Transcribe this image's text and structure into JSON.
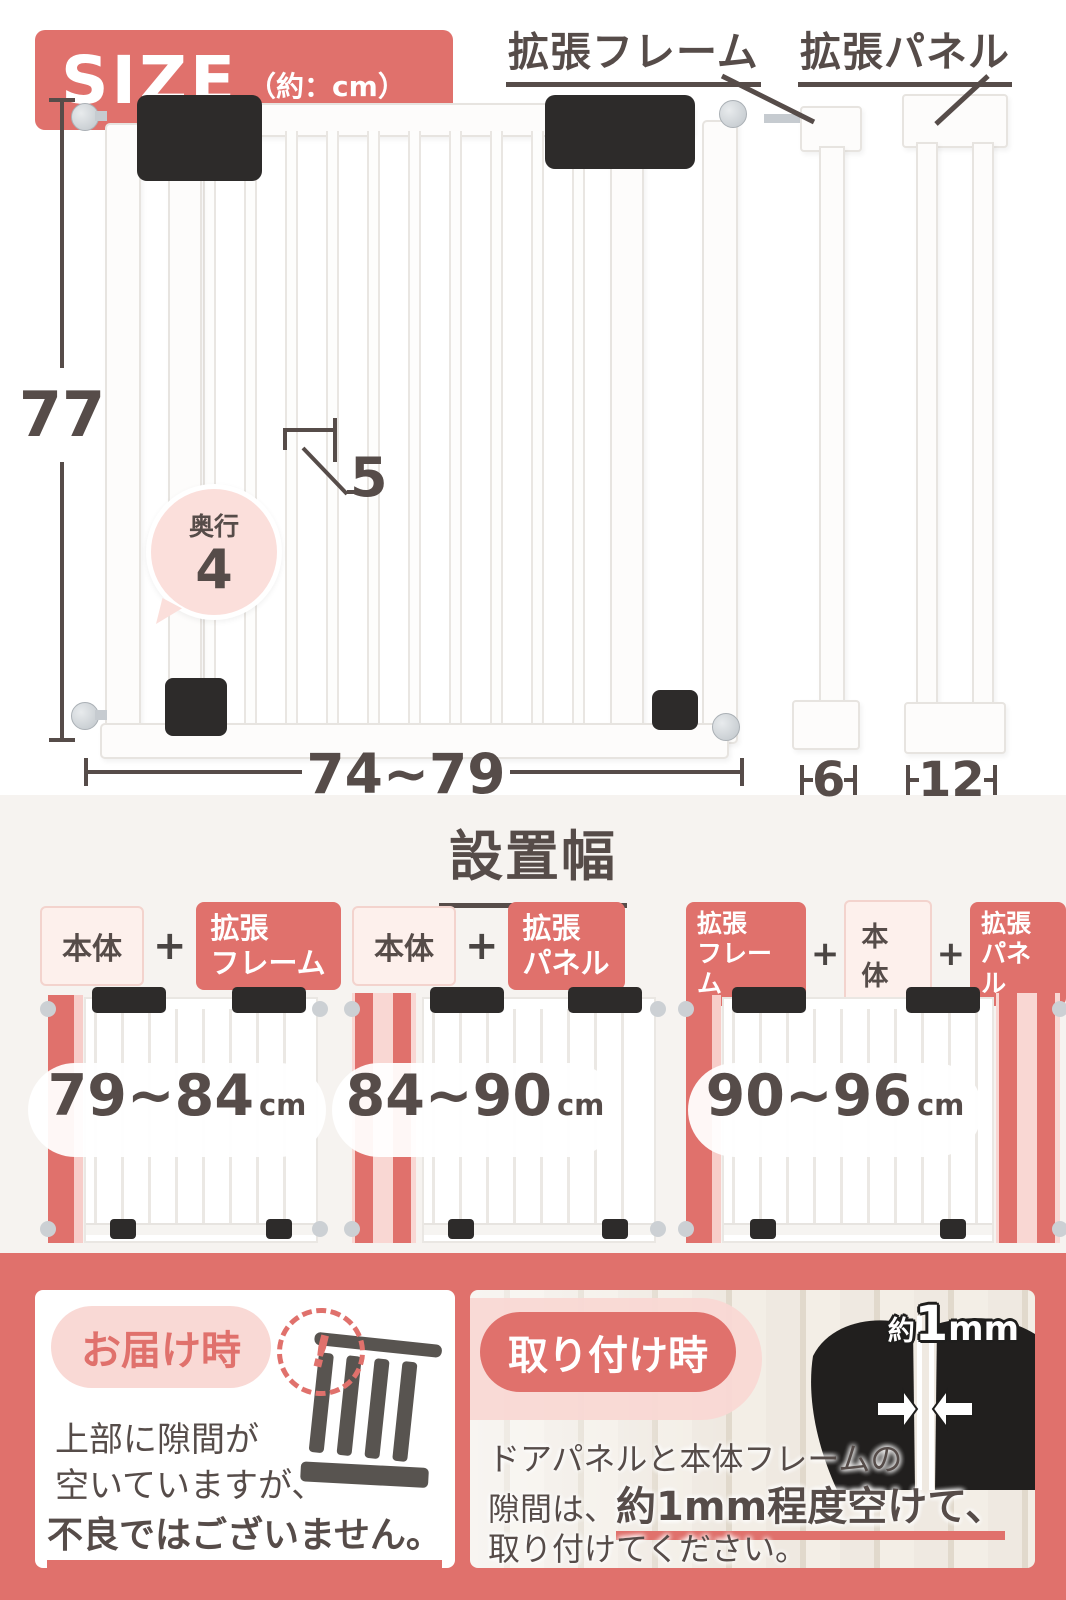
{
  "colors": {
    "accent_salmon": "#E0716C",
    "text_dark": "#564C49",
    "light_pink": "#F9D9D5",
    "section_bg": "#F6F3F0"
  },
  "size_section": {
    "badge_title": "SIZE",
    "badge_unit": "（約：cm）",
    "label_frame": "拡張フレーム",
    "label_panel": "拡張パネル",
    "dim_height": "77",
    "dim_width": "74~79",
    "dim_top_gap": "5",
    "depth_label": "奥行",
    "depth_value": "4",
    "dim_frame_width": "6",
    "dim_panel_width": "12"
  },
  "width_section": {
    "title": "設置幅",
    "plus": "+",
    "combos": [
      {
        "badges": [
          {
            "line1": "本体"
          },
          {
            "line1": "拡張",
            "line2": "フレーム"
          }
        ],
        "range": "79~84",
        "unit": "cm"
      },
      {
        "badges": [
          {
            "line1": "本体"
          },
          {
            "line1": "拡張",
            "line2": "パネル"
          }
        ],
        "range": "84~90",
        "unit": "cm"
      },
      {
        "badges": [
          {
            "line1": "拡張",
            "line2": "フレーム"
          },
          {
            "line1": "本体"
          },
          {
            "line1": "拡張",
            "line2": "パネル"
          }
        ],
        "range": "90~96",
        "unit": "cm"
      }
    ]
  },
  "notes_section": {
    "delivery": {
      "title": "お届け時",
      "alert": "!",
      "line1": "上部に隙間が",
      "line2": "空いていますが、",
      "line3": "不良ではございません。"
    },
    "install": {
      "title": "取り付け時",
      "gap_small": "約",
      "gap_big": "1",
      "gap_unit": "mm",
      "line1": "ドアパネルと本体フレームの",
      "line2_pre": "隙間は、",
      "line2_em": "約1mm程度空けて、",
      "line3": "取り付けてください。"
    }
  }
}
